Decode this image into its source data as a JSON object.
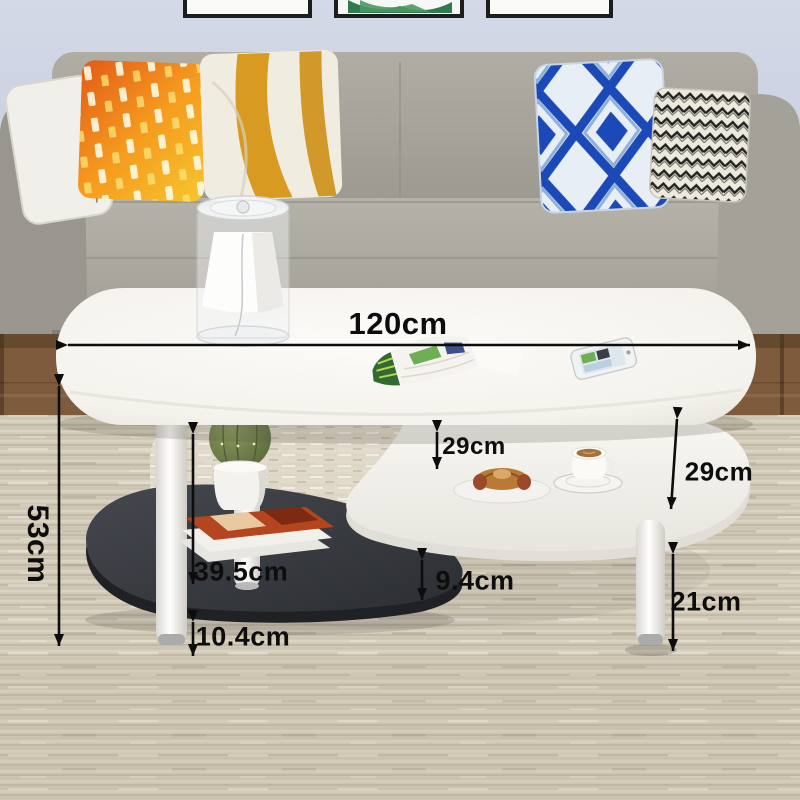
{
  "annotations": {
    "table_width": "120cm",
    "table_height": "53cm",
    "mid_shelf_clearance": "29cm",
    "right_shelf_clearance": "29cm",
    "left_leg_upper_height": "39.5cm",
    "left_leg_lower_height": "10.4cm",
    "lower_shelf_edge_height": "9.4cm",
    "right_leg_height": "21cm"
  },
  "colors": {
    "annotation_text": "#0d0d0d",
    "wall": "#cdd3e2",
    "sofa_fabric": "#a8a59c",
    "table_top_white": "#f8f7f3",
    "lower_shelf_black": "#34373c",
    "rug_beige": "#cfc7b6",
    "wood_floor_brown": "#7a583a",
    "pillow_orange": "#ef8c1f",
    "pillow_blue": "#1c49b8",
    "pillow_stripe_gold": "#d89a20",
    "plant_green": "#6b7a45"
  },
  "icons": {
    "dimension_arrows": "double-headed-arrow"
  }
}
